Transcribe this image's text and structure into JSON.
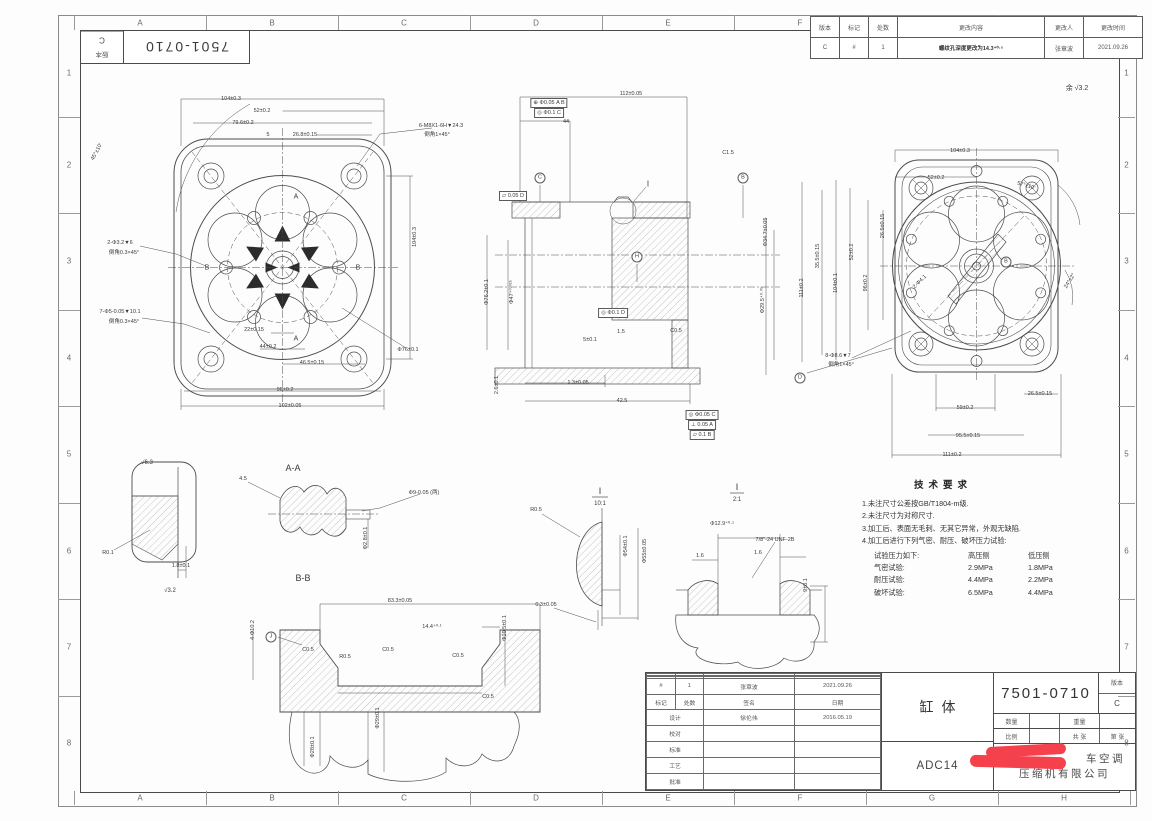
{
  "sheet": {
    "zones_cols": [
      "A",
      "B",
      "C",
      "D",
      "E",
      "F",
      "G",
      "H"
    ],
    "zones_rows": [
      "1",
      "2",
      "3",
      "4",
      "5",
      "6",
      "7",
      "8"
    ]
  },
  "corner_block": {
    "part_no": "7501-0710",
    "version_label": "版本",
    "version": "C"
  },
  "revision_table": {
    "headers": [
      "版本",
      "标记",
      "处数",
      "更改内容",
      "更改人",
      "更改时间"
    ],
    "row": [
      "C",
      "#",
      "1",
      "螺纹孔深度更改为14.3⁺⁰·⁵",
      "张章波",
      "2021.09.26"
    ]
  },
  "surface_note": "余 √3.2",
  "tech_requirements": {
    "title": "技术要求",
    "notes": [
      "1.未注尺寸公差按GB/T1804-m级.",
      "2.未注尺寸为对称尺寸.",
      "3.加工后、表面无毛刺、无其它异常，外观无缺陷.",
      "4.加工后进行下列气密、耐压、破坏压力试验:"
    ],
    "pressure_table": {
      "header": [
        "试验压力如下:",
        "高压侧",
        "低压侧"
      ],
      "rows": [
        [
          "气密试验:",
          "2.9MPa",
          "1.8MPa"
        ],
        [
          "耐压试验:",
          "4.4MPa",
          "2.2MPa"
        ],
        [
          "破坏试验:",
          "6.5MPa",
          "4.4MPa"
        ]
      ]
    }
  },
  "title_block": {
    "sign_rows": [
      [
        "",
        "",
        "",
        ""
      ],
      [
        "",
        "",
        "",
        ""
      ],
      [
        "",
        "",
        "",
        ""
      ],
      [
        "#",
        "1",
        "张章波",
        "2021.09.26"
      ],
      [
        "标记",
        "处数",
        "签名",
        "日期"
      ],
      [
        "设计",
        "",
        "徐伦伟",
        "2016.05.19"
      ],
      [
        "校对",
        "",
        "",
        ""
      ],
      [
        "标准",
        "",
        "",
        ""
      ],
      [
        "工艺",
        "",
        "",
        ""
      ],
      [
        "批准",
        "",
        "",
        ""
      ]
    ],
    "part_name": "缸体",
    "material": "ADC14",
    "part_no": "7501-0710",
    "version_label": "版本",
    "version": "C",
    "row2": [
      "数量",
      "",
      "重量",
      ""
    ],
    "row3": [
      "比例",
      "",
      "共  张",
      "第  张"
    ],
    "company_line1": "车空调",
    "company_line2": "压缩机有限公司"
  },
  "annotations": [
    {
      "x": 231,
      "y": 99,
      "t": "104±0.3"
    },
    {
      "x": 262,
      "y": 111,
      "t": "52±0.2"
    },
    {
      "x": 243,
      "y": 123,
      "t": "79.6±0.2"
    },
    {
      "x": 305,
      "y": 135,
      "t": "26.8±0.15"
    },
    {
      "x": 268,
      "y": 135,
      "t": "5"
    },
    {
      "x": 441,
      "y": 126,
      "t": "6-M8X1-6H▼24.3"
    },
    {
      "x": 437,
      "y": 134,
      "t": "倒角1×45°"
    },
    {
      "x": 120,
      "y": 243,
      "t": "2-Φ3.2▼6"
    },
    {
      "x": 124,
      "y": 252,
      "t": "倒角0.3×45°"
    },
    {
      "x": 120,
      "y": 312,
      "t": "7-Φ5-0.05▼10.1"
    },
    {
      "x": 124,
      "y": 321,
      "t": "倒角0.3×45°"
    },
    {
      "x": 254,
      "y": 330,
      "t": "22±0.15"
    },
    {
      "x": 268,
      "y": 347,
      "t": "44±0.2"
    },
    {
      "x": 312,
      "y": 363,
      "t": "46.5±0.15"
    },
    {
      "x": 285,
      "y": 390,
      "t": "96±0.2"
    },
    {
      "x": 290,
      "y": 406,
      "t": "102±0.05"
    },
    {
      "x": 408,
      "y": 350,
      "t": "Φ76±0.1"
    },
    {
      "x": 97,
      "y": 152,
      "t": "45°±10'",
      "r": -62
    },
    {
      "x": 415,
      "y": 237,
      "t": "104±0.3",
      "r": -90
    },
    {
      "x": 296,
      "y": 197,
      "t": "A",
      "s": 7
    },
    {
      "x": 296,
      "y": 339,
      "t": "A",
      "s": 7
    },
    {
      "x": 207,
      "y": 268,
      "t": "B",
      "s": 7
    },
    {
      "x": 358,
      "y": 268,
      "t": "B",
      "s": 7
    },
    {
      "x": 631,
      "y": 94,
      "t": "112±0.05"
    },
    {
      "x": 566,
      "y": 122,
      "t": "44"
    },
    {
      "x": 549,
      "y": 103,
      "t": "⊕ Φ0.05 A B",
      "b": 1
    },
    {
      "x": 549,
      "y": 113,
      "t": "◎ Φ0.1 C",
      "b": 1
    },
    {
      "x": 513,
      "y": 196,
      "t": "⏥ 0.05 D",
      "b": 1
    },
    {
      "x": 540,
      "y": 178,
      "t": "C",
      "c": 1
    },
    {
      "x": 743,
      "y": 178,
      "t": "B",
      "c": 1
    },
    {
      "x": 637,
      "y": 257,
      "t": "H",
      "c": 1
    },
    {
      "x": 648,
      "y": 184,
      "t": "I",
      "s": 8
    },
    {
      "x": 728,
      "y": 153,
      "t": "C1.5"
    },
    {
      "x": 766,
      "y": 232,
      "t": "Φ34.7±0.05",
      "r": -90
    },
    {
      "x": 763,
      "y": 300,
      "t": "Φ29.5⁺⁰·⁰⁵",
      "r": -90
    },
    {
      "x": 487,
      "y": 292,
      "t": "Φ76.2±0.1",
      "r": -90
    },
    {
      "x": 512,
      "y": 292,
      "t": "Φ47⁺⁰·⁰²⁵",
      "r": -90
    },
    {
      "x": 590,
      "y": 340,
      "t": "5±0.1"
    },
    {
      "x": 497,
      "y": 385,
      "t": "2.6±0.1",
      "r": -90
    },
    {
      "x": 578,
      "y": 383,
      "t": "1.3±0.05"
    },
    {
      "x": 622,
      "y": 401,
      "t": "42.5"
    },
    {
      "x": 613,
      "y": 313,
      "t": "◎ Φ0.1 D",
      "b": 1
    },
    {
      "x": 702,
      "y": 415,
      "t": "◎ Φ0.05 C",
      "b": 1
    },
    {
      "x": 702,
      "y": 425,
      "t": "⊥ 0.05 A",
      "b": 1
    },
    {
      "x": 702,
      "y": 435,
      "t": "⏥ 0.1 B",
      "b": 1
    },
    {
      "x": 676,
      "y": 331,
      "t": "C0.5"
    },
    {
      "x": 621,
      "y": 332,
      "t": "1.5"
    },
    {
      "x": 960,
      "y": 151,
      "t": "104±0.3"
    },
    {
      "x": 936,
      "y": 178,
      "t": "52±0.2"
    },
    {
      "x": 1026,
      "y": 186,
      "t": "57°±10'",
      "r": 16
    },
    {
      "x": 1070,
      "y": 281,
      "t": "24°±2°",
      "r": -58
    },
    {
      "x": 802,
      "y": 288,
      "t": "111±0.2",
      "r": -90
    },
    {
      "x": 818,
      "y": 256,
      "t": "35.5±0.15",
      "r": -90
    },
    {
      "x": 836,
      "y": 283,
      "t": "104±0.1",
      "r": -90
    },
    {
      "x": 852,
      "y": 252,
      "t": "52±0.2",
      "r": -90
    },
    {
      "x": 866,
      "y": 283,
      "t": "96±0.2",
      "r": -90
    },
    {
      "x": 883,
      "y": 226,
      "t": "26.5±0.15",
      "r": -90
    },
    {
      "x": 920,
      "y": 282,
      "t": "2-Φ4.1",
      "r": -45
    },
    {
      "x": 1006,
      "y": 262,
      "t": "B",
      "c": 1
    },
    {
      "x": 965,
      "y": 408,
      "t": "59±0.2"
    },
    {
      "x": 968,
      "y": 436,
      "t": "95.5±0.15"
    },
    {
      "x": 952,
      "y": 455,
      "t": "111±0.2"
    },
    {
      "x": 1040,
      "y": 394,
      "t": "26.5±0.15"
    },
    {
      "x": 838,
      "y": 356,
      "t": "8-Φ8.6▼7"
    },
    {
      "x": 841,
      "y": 364,
      "t": "倒角1×45°"
    },
    {
      "x": 800,
      "y": 378,
      "t": "D",
      "c": 1
    },
    {
      "x": 293,
      "y": 468,
      "t": "A-A",
      "s": 9
    },
    {
      "x": 147,
      "y": 463,
      "t": "√6.3",
      "s": 6
    },
    {
      "x": 108,
      "y": 553,
      "t": "R0.1"
    },
    {
      "x": 181,
      "y": 566,
      "t": "1.8±0.1"
    },
    {
      "x": 170,
      "y": 591,
      "t": "√3.2",
      "s": 6
    },
    {
      "x": 243,
      "y": 479,
      "t": "4.5"
    },
    {
      "x": 366,
      "y": 538,
      "t": "Φ2.8±0.1",
      "r": -90
    },
    {
      "x": 424,
      "y": 492,
      "t": "Φ9-0.05 (两)"
    },
    {
      "x": 303,
      "y": 578,
      "t": "B-B",
      "s": 9
    },
    {
      "x": 400,
      "y": 601,
      "t": "83.3±0.05"
    },
    {
      "x": 432,
      "y": 627,
      "t": "14.4⁺⁰·¹"
    },
    {
      "x": 345,
      "y": 657,
      "t": "R0.5"
    },
    {
      "x": 308,
      "y": 650,
      "t": "C0.5"
    },
    {
      "x": 388,
      "y": 650,
      "t": "C0.5"
    },
    {
      "x": 458,
      "y": 656,
      "t": "C0.5"
    },
    {
      "x": 271,
      "y": 637,
      "t": "J",
      "c": 1
    },
    {
      "x": 253,
      "y": 630,
      "t": "4-Φ10.2",
      "r": -90
    },
    {
      "x": 505,
      "y": 628,
      "t": "Φ10.5±0.1",
      "r": -90
    },
    {
      "x": 313,
      "y": 747,
      "t": "Φ28±0.1",
      "r": -90
    },
    {
      "x": 378,
      "y": 718,
      "t": "Φ29±0.1",
      "r": -90
    },
    {
      "x": 488,
      "y": 697,
      "t": "C0.5"
    },
    {
      "x": 600,
      "y": 491,
      "t": "I",
      "s": 9
    },
    {
      "x": 600,
      "y": 504,
      "t": "10:1",
      "s": 6
    },
    {
      "x": 536,
      "y": 510,
      "t": "R0.5"
    },
    {
      "x": 626,
      "y": 546,
      "t": "Φ54±0.1",
      "r": -90
    },
    {
      "x": 645,
      "y": 551,
      "t": "Φ55±0.05",
      "r": -90
    },
    {
      "x": 546,
      "y": 605,
      "t": "0.3±0.05"
    },
    {
      "x": 737,
      "y": 487,
      "t": "I",
      "s": 9
    },
    {
      "x": 737,
      "y": 500,
      "t": "2:1",
      "s": 6
    },
    {
      "x": 722,
      "y": 524,
      "t": "Φ12.9⁺⁰·¹"
    },
    {
      "x": 775,
      "y": 540,
      "t": "7/8\"-24 UNF-2B"
    },
    {
      "x": 700,
      "y": 556,
      "t": "1.6"
    },
    {
      "x": 758,
      "y": 553,
      "t": "1.6"
    },
    {
      "x": 806,
      "y": 585,
      "t": "9±0.1",
      "r": -90
    },
    {
      "x": 1077,
      "y": 88,
      "t": "余 √3.2",
      "s": 7
    }
  ]
}
